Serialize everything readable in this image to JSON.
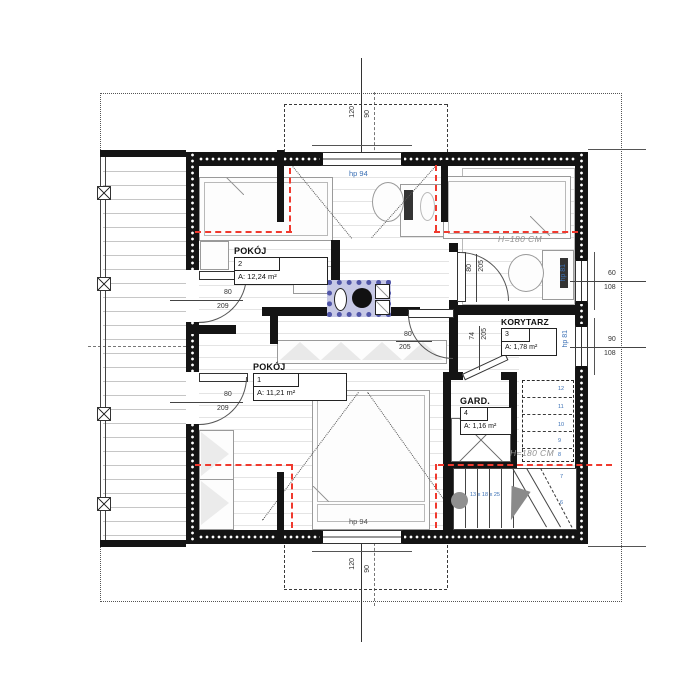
{
  "drawing": {
    "type_label": "attic floor plan"
  },
  "rooms": {
    "pokoj2": {
      "name": "POKÓJ",
      "number": "2",
      "area": "A: 12,24 m²"
    },
    "pokoj1": {
      "name": "POKÓJ",
      "number": "1",
      "area": "A: 11,21 m²"
    },
    "korytarz": {
      "name": "KORYTARZ",
      "number": "3",
      "area": "A: 1,78 m²"
    },
    "gard": {
      "name": "GARD.",
      "number": "4",
      "area": "A: 1,16 m²"
    }
  },
  "annotations": {
    "height_line_top": "H=180 CM",
    "height_line_bottom": "H=180 CM",
    "window_top": "hp 94",
    "window_bottom": "hp 94",
    "window_right_upper": "hp 81",
    "window_right_lower": "hp 81",
    "stair_formula": "13 x 18 x 25"
  },
  "dims": {
    "axis_top": {
      "a": "120",
      "b": "90"
    },
    "axis_bottom": {
      "a": "120",
      "b": "90"
    },
    "door_left_top": {
      "w": "80",
      "h": "209"
    },
    "door_left_bottom": {
      "w": "80",
      "h": "209"
    },
    "door_chimney": {
      "w": "80",
      "h": "205"
    },
    "door_room_right": {
      "w": "80",
      "h": "205"
    },
    "door_korytarz": {
      "w": "74",
      "h": "205"
    },
    "window_right_upper": {
      "w": "60",
      "h": "108"
    },
    "window_right_lower": {
      "w": "90",
      "h": "108"
    }
  },
  "stairs": {
    "steps": [
      "12",
      "11",
      "10",
      "9",
      "8",
      "7",
      "6"
    ]
  },
  "colors": {
    "knee_wall_line": "#f0392e",
    "chimney_hatch": "#5156a8",
    "annotation_blue": "#3b70b5",
    "wall": "#141414"
  }
}
